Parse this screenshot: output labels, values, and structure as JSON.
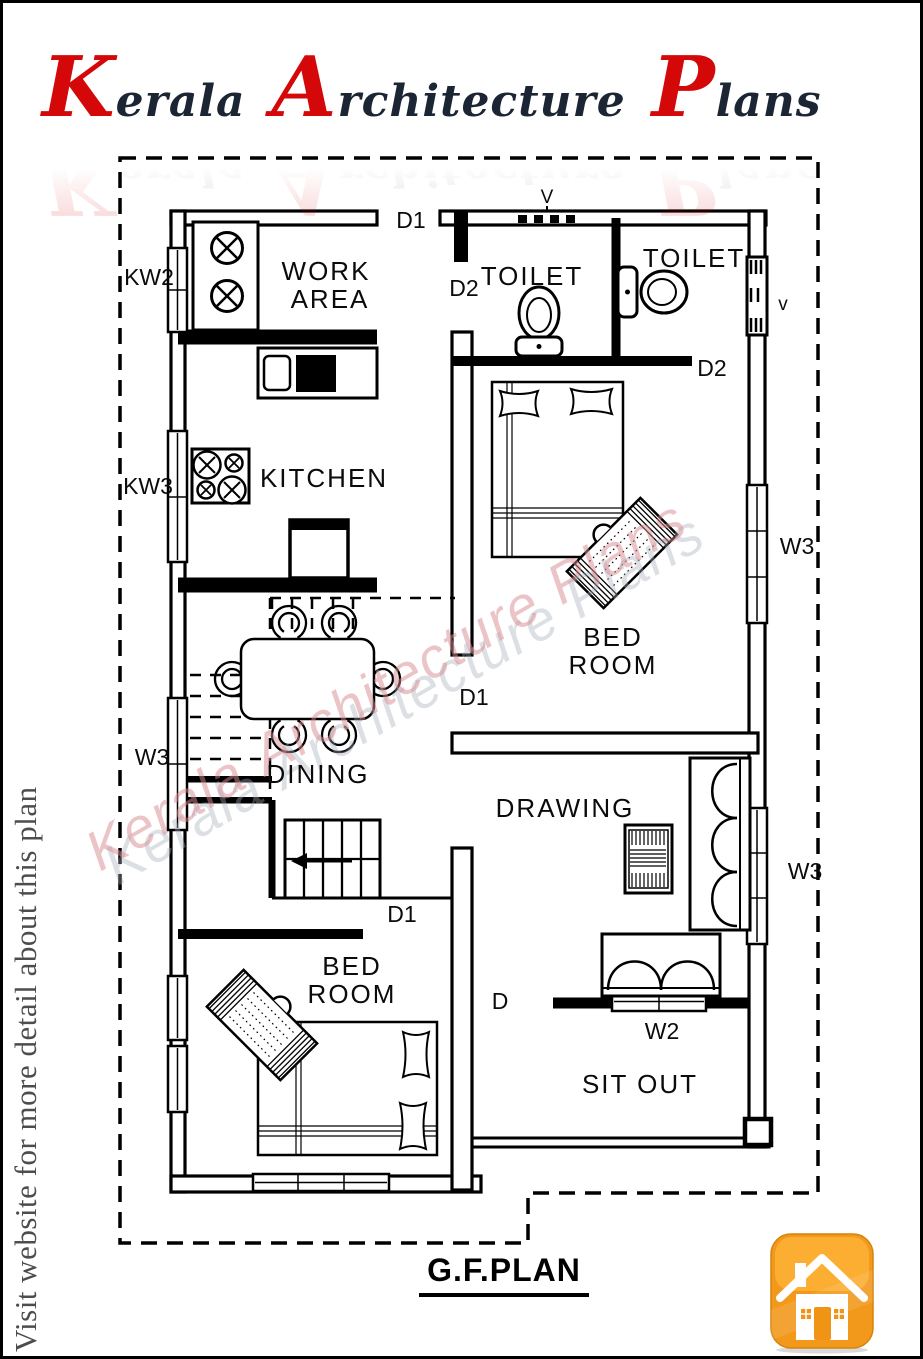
{
  "header": {
    "logo_words": [
      "Kerala",
      "Architecture",
      "Plans"
    ]
  },
  "side_note": "Visit website for more detail about this plan",
  "watermark_words": [
    "Kerala",
    "Architecture",
    "Plans"
  ],
  "plan_title": "G.F.PLAN",
  "rooms": {
    "work_area_line1": "WORK",
    "work_area_line2": "AREA",
    "kitchen": "KITCHEN",
    "toilet_1": "TOILET",
    "toilet_2": "TOILET",
    "bedroom_1_line1": "BED",
    "bedroom_1_line2": "ROOM",
    "dining": "DINING",
    "drawing": "DRAWING",
    "bedroom_2_line1": "BED",
    "bedroom_2_line2": "ROOM",
    "sit_out": "SIT OUT"
  },
  "labels": {
    "door_top": "D1",
    "door_toilet_1": "D2",
    "door_toilet_2": "D2",
    "door_bedroom_1": "D1",
    "door_bedroom_2": "D1",
    "door_sit_out": "D",
    "window_work_area": "KW2",
    "window_kitchen": "KW3",
    "window_dining": "W3",
    "window_bedroom_1": "W3",
    "window_drawing": "W3",
    "window_front": "W2",
    "vent_top": "V",
    "vent_right": "v"
  },
  "icons": {
    "home": "home-icon"
  },
  "colors": {
    "logo_red": "#d40808",
    "logo_dark": "#1b2533",
    "watermark_pink": "#dd8f96",
    "watermark_shadow": "#a6b0ba",
    "note_gray": "#4d4d4d",
    "line_black": "#000000",
    "icon_orange": "#f6a21d"
  }
}
